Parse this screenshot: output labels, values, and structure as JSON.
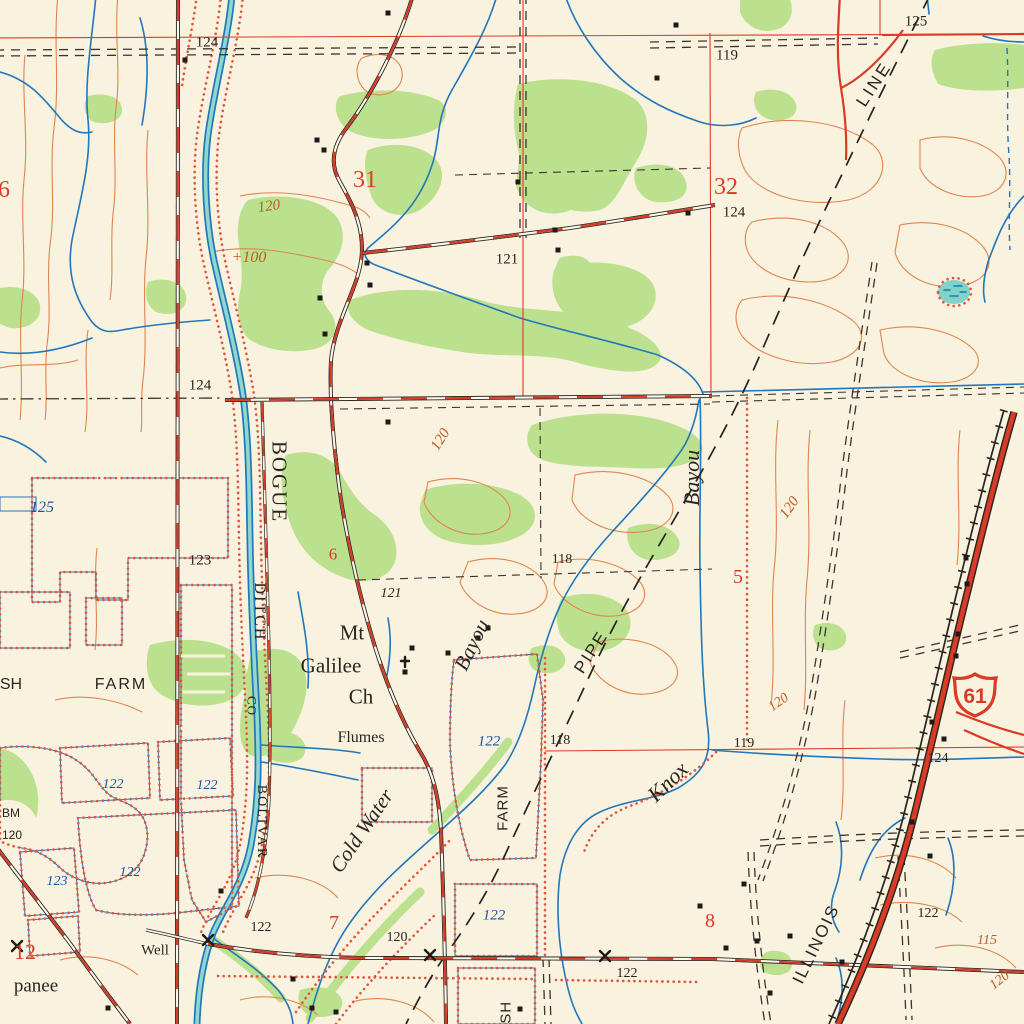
{
  "map": {
    "kind": "topographic map",
    "highway_shield": {
      "number": "61"
    }
  },
  "colors": {
    "background": "#f8f2df",
    "woodland": "#bce18e",
    "water_fill": "#7fd3c8",
    "water_line": "#2276bb",
    "contour": "#e0854e",
    "contour_label": "#bf5b22",
    "red": "#da3b27",
    "levee_dot": "#e2543b",
    "black": "#2b2520",
    "water_label": "#1a55a0"
  },
  "labels": [
    {
      "n": "spot-elevation-label",
      "t": "124",
      "x": 207,
      "y": 43,
      "s": 15,
      "c": "k",
      "f": "rs"
    },
    {
      "n": "spot-elevation-label",
      "t": "125",
      "x": 916,
      "y": 22,
      "s": 15,
      "c": "k",
      "f": "rs"
    },
    {
      "n": "spot-elevation-label",
      "t": "119",
      "x": 727,
      "y": 56,
      "s": 15,
      "c": "k",
      "f": "rs"
    },
    {
      "n": "section-number-label",
      "t": "6",
      "x": 4,
      "y": 190,
      "s": 24,
      "c": "r",
      "f": "rs"
    },
    {
      "n": "section-number-label",
      "t": "31",
      "x": 365,
      "y": 180,
      "s": 24,
      "c": "r",
      "f": "rs"
    },
    {
      "n": "section-number-label",
      "t": "32",
      "x": 726,
      "y": 187,
      "s": 24,
      "c": "r",
      "f": "rs"
    },
    {
      "n": "spot-elevation-label",
      "t": "124",
      "x": 734,
      "y": 213,
      "s": 15,
      "c": "k",
      "f": "rs"
    },
    {
      "n": "contour-label",
      "t": "120",
      "x": 269,
      "y": 207,
      "s": 15,
      "c": "b",
      "f": "ri",
      "r": -8
    },
    {
      "n": "contour-label",
      "t": "+100",
      "x": 249,
      "y": 258,
      "s": 16,
      "c": "b",
      "f": "ri"
    },
    {
      "n": "spot-elevation-label",
      "t": "121",
      "x": 507,
      "y": 260,
      "s": 15,
      "c": "k",
      "f": "rs"
    },
    {
      "n": "spot-elevation-label",
      "t": "124",
      "x": 200,
      "y": 386,
      "s": 15,
      "c": "k",
      "f": "rs"
    },
    {
      "n": "contour-label",
      "t": "120",
      "x": 441,
      "y": 440,
      "s": 15,
      "c": "b",
      "f": "ri",
      "r": -58
    },
    {
      "n": "pipeline-label",
      "t": "LINE",
      "x": 874,
      "y": 84,
      "s": 17,
      "c": "k",
      "f": "ss",
      "r": -57,
      "sp": 3
    },
    {
      "n": "stream-name-label",
      "t": "BOGUE",
      "x": 279,
      "y": 482,
      "s": 21,
      "c": "k",
      "f": "rs",
      "r": 90,
      "sp": 2
    },
    {
      "n": "stream-name-label",
      "t": "DITCH",
      "x": 259,
      "y": 612,
      "s": 16,
      "c": "k",
      "f": "rs",
      "r": 90,
      "sp": 2
    },
    {
      "n": "stream-name-label",
      "t": "CO",
      "x": 252,
      "y": 706,
      "s": 13,
      "c": "k",
      "f": "rs",
      "r": 90,
      "sp": 1
    },
    {
      "n": "stream-name-label",
      "t": "BOLIVAR",
      "x": 261,
      "y": 822,
      "s": 14,
      "c": "k",
      "f": "rs",
      "r": 90,
      "sp": 2
    },
    {
      "n": "water-elevation-label",
      "t": "125",
      "x": 42,
      "y": 508,
      "s": 16,
      "c": "u",
      "f": "ri"
    },
    {
      "n": "spot-elevation-label",
      "t": "123",
      "x": 200,
      "y": 561,
      "s": 15,
      "c": "k",
      "f": "rs"
    },
    {
      "n": "section-number-label",
      "t": "6",
      "x": 333,
      "y": 554,
      "s": 17,
      "c": "r",
      "f": "rs"
    },
    {
      "n": "spot-elevation-label",
      "t": "121",
      "x": 391,
      "y": 594,
      "s": 14,
      "c": "k",
      "f": "ri"
    },
    {
      "n": "spot-elevation-label",
      "t": "118",
      "x": 562,
      "y": 560,
      "s": 14,
      "c": "k",
      "f": "rs"
    },
    {
      "n": "stream-name-label",
      "t": "Bayou",
      "x": 692,
      "y": 478,
      "s": 22,
      "c": "k",
      "f": "ri",
      "r": -90
    },
    {
      "n": "section-number-label",
      "t": "5",
      "x": 738,
      "y": 577,
      "s": 20,
      "c": "r",
      "f": "rs"
    },
    {
      "n": "contour-label",
      "t": "120",
      "x": 790,
      "y": 508,
      "s": 15,
      "c": "b",
      "f": "ri",
      "r": -55
    },
    {
      "n": "pipeline-label",
      "t": "PIPE",
      "x": 591,
      "y": 652,
      "s": 17,
      "c": "k",
      "f": "ss",
      "r": -57,
      "sp": 2
    },
    {
      "n": "stream-name-label",
      "t": "Knox",
      "x": 668,
      "y": 782,
      "s": 22,
      "c": "k",
      "f": "ri",
      "r": -44
    },
    {
      "n": "spot-elevation-label",
      "t": "119",
      "x": 744,
      "y": 744,
      "s": 14,
      "c": "k",
      "f": "rs"
    },
    {
      "n": "spot-elevation-label",
      "t": "118",
      "x": 560,
      "y": 741,
      "s": 14,
      "c": "k",
      "f": "rs"
    },
    {
      "n": "contour-label",
      "t": "120",
      "x": 779,
      "y": 703,
      "s": 14,
      "c": "b",
      "f": "ri",
      "r": -35
    },
    {
      "n": "church-name-label",
      "t": "Mt",
      "x": 352,
      "y": 633,
      "s": 21,
      "c": "k",
      "f": "rs"
    },
    {
      "n": "church-name-label",
      "t": "Galilee",
      "x": 331,
      "y": 666,
      "s": 21,
      "c": "k",
      "f": "rs"
    },
    {
      "n": "church-name-label",
      "t": "Ch",
      "x": 361,
      "y": 697,
      "s": 21,
      "c": "k",
      "f": "rs"
    },
    {
      "n": "feature-label",
      "t": "Flumes",
      "x": 361,
      "y": 738,
      "s": 16,
      "c": "k",
      "f": "rs"
    },
    {
      "n": "stream-name-label",
      "t": "Bayou",
      "x": 472,
      "y": 645,
      "s": 21,
      "c": "k",
      "f": "ri",
      "r": -64
    },
    {
      "n": "water-elevation-label",
      "t": "122",
      "x": 489,
      "y": 742,
      "s": 15,
      "c": "u",
      "f": "ri"
    },
    {
      "n": "feature-label",
      "t": "FARM",
      "x": 503,
      "y": 808,
      "s": 15,
      "c": "k",
      "f": "ss",
      "r": -90,
      "sp": 1
    },
    {
      "n": "feature-label",
      "t": "SH",
      "x": 11,
      "y": 685,
      "s": 16,
      "c": "k",
      "f": "ss"
    },
    {
      "n": "feature-label",
      "t": "FARM",
      "x": 121,
      "y": 685,
      "s": 16,
      "c": "k",
      "f": "ss",
      "sp": 2
    },
    {
      "n": "water-elevation-label",
      "t": "122",
      "x": 113,
      "y": 785,
      "s": 14,
      "c": "u",
      "f": "ri"
    },
    {
      "n": "water-elevation-label",
      "t": "122",
      "x": 207,
      "y": 786,
      "s": 14,
      "c": "u",
      "f": "ri"
    },
    {
      "n": "benchmark-label",
      "t": "BM",
      "x": 11,
      "y": 813,
      "s": 12,
      "c": "k",
      "f": "ss"
    },
    {
      "n": "benchmark-label",
      "t": "120",
      "x": 12,
      "y": 835,
      "s": 12,
      "c": "k",
      "f": "ss"
    },
    {
      "n": "water-elevation-label",
      "t": "123",
      "x": 57,
      "y": 882,
      "s": 14,
      "c": "u",
      "f": "ri"
    },
    {
      "n": "water-elevation-label",
      "t": "122",
      "x": 130,
      "y": 873,
      "s": 14,
      "c": "u",
      "f": "ri"
    },
    {
      "n": "section-number-label",
      "t": "12",
      "x": 25,
      "y": 952,
      "s": 22,
      "c": "r",
      "f": "rs"
    },
    {
      "n": "place-name-label",
      "t": "panee",
      "x": 36,
      "y": 986,
      "s": 19,
      "c": "k",
      "f": "rs"
    },
    {
      "n": "feature-label",
      "t": "Well",
      "x": 155,
      "y": 951,
      "s": 15,
      "c": "k",
      "f": "rs"
    },
    {
      "n": "spot-elevation-label",
      "t": "122",
      "x": 261,
      "y": 928,
      "s": 14,
      "c": "k",
      "f": "rs"
    },
    {
      "n": "section-number-label",
      "t": "7",
      "x": 334,
      "y": 923,
      "s": 20,
      "c": "r",
      "f": "rs"
    },
    {
      "n": "spot-elevation-label",
      "t": "120",
      "x": 397,
      "y": 938,
      "s": 14,
      "c": "k",
      "f": "rs"
    },
    {
      "n": "water-elevation-label",
      "t": "122",
      "x": 494,
      "y": 916,
      "s": 15,
      "c": "u",
      "f": "ri"
    },
    {
      "n": "spot-elevation-label",
      "t": "122",
      "x": 627,
      "y": 974,
      "s": 14,
      "c": "k",
      "f": "rs"
    },
    {
      "n": "section-number-label",
      "t": "8",
      "x": 710,
      "y": 921,
      "s": 20,
      "c": "r",
      "f": "rs"
    },
    {
      "n": "railroad-name-label",
      "t": "ILLINOIS",
      "x": 816,
      "y": 944,
      "s": 17,
      "c": "k",
      "f": "ss",
      "r": -64,
      "sp": 2
    },
    {
      "n": "spot-elevation-label",
      "t": "122",
      "x": 928,
      "y": 914,
      "s": 14,
      "c": "k",
      "f": "rs"
    },
    {
      "n": "contour-label",
      "t": "115",
      "x": 987,
      "y": 941,
      "s": 14,
      "c": "b",
      "f": "ri"
    },
    {
      "n": "contour-label",
      "t": "120",
      "x": 1000,
      "y": 981,
      "s": 14,
      "c": "b",
      "f": "ri",
      "r": -38
    },
    {
      "n": "spot-elevation-label",
      "t": "124",
      "x": 938,
      "y": 759,
      "s": 14,
      "c": "k",
      "f": "rs"
    },
    {
      "n": "feature-label",
      "t": "FISH",
      "x": 506,
      "y": 1020,
      "s": 15,
      "c": "k",
      "f": "ss",
      "r": -90,
      "sp": 1
    },
    {
      "n": "stream-name-label",
      "t": "Cold Water",
      "x": 362,
      "y": 831,
      "s": 21,
      "c": "k",
      "f": "ri",
      "r": -56
    }
  ]
}
